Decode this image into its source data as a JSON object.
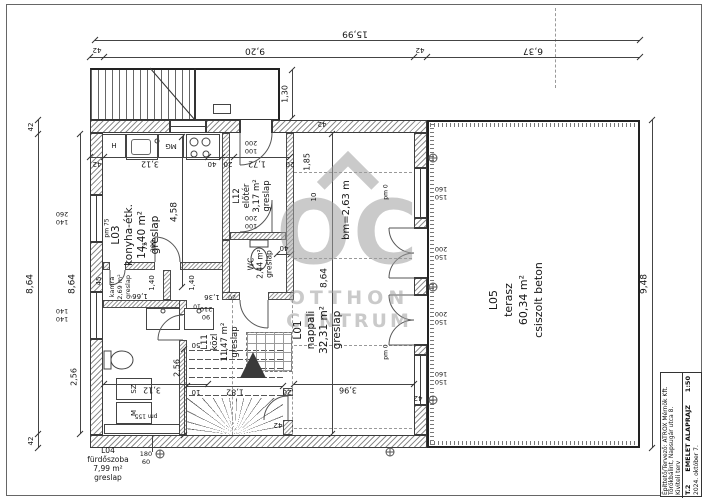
{
  "title_block": {
    "owner_designer": "Építtető/Tervező: ATROX Mérnök Kft.",
    "address": "Törökbálint, Napsugár utca 8.",
    "plan_type": "Kiviteli terv",
    "sheet_number": "T.2",
    "sheet_title": "EMELET ALAPRAJZ",
    "scale": "1:50",
    "date": "2024. október 7."
  },
  "watermark": {
    "monogram": "OC",
    "line1": "OTTHON",
    "line2": "CENTRUM"
  },
  "colors": {
    "line": "#3c3c3c",
    "hatch": "#8d8d8d",
    "watermark": "#c8c8c8"
  },
  "plan": {
    "room_labels": [
      {
        "n": "room-label-l03",
        "lines": [
          "L03",
          "konyha-étk.",
          "14,40 m²",
          "greslap"
        ],
        "x": 136,
        "y": 235,
        "rot": 90,
        "fs": 10.5,
        "lh": 13
      },
      {
        "n": "room-label-l12",
        "lines": [
          "L12",
          "előtér",
          "3,17 m²",
          "greslap"
        ],
        "x": 252,
        "y": 196,
        "rot": 90,
        "fs": 8.5,
        "lh": 10
      },
      {
        "n": "room-label-wc",
        "lines": [
          "WC",
          "2,44 m²",
          "greslap"
        ],
        "x": 260,
        "y": 264,
        "rot": 90,
        "fs": 7.5,
        "lh": 9
      },
      {
        "n": "room-label-kamra",
        "lines": [
          "kamra",
          "2,69 m²",
          "greslap"
        ],
        "x": 120,
        "y": 287,
        "rot": 90,
        "fs": 6.5,
        "lh": 8
      },
      {
        "n": "room-label-l11",
        "lines": [
          "L11",
          "közl",
          "11,47 m²",
          "greslap"
        ],
        "x": 220,
        "y": 342,
        "rot": 90,
        "fs": 8.5,
        "lh": 10
      },
      {
        "n": "room-label-l01",
        "lines": [
          "L01",
          "nappali",
          "32,31 m²",
          "greslap"
        ],
        "x": 318,
        "y": 330,
        "rot": 90,
        "fs": 10.5,
        "lh": 13
      },
      {
        "n": "room-label-l05",
        "lines": [
          "L05",
          "terasz",
          "60,34 m²",
          "csiszolt beton"
        ],
        "x": 516,
        "y": 300,
        "rot": 90,
        "fs": 11,
        "lh": 15
      },
      {
        "n": "room-label-l04",
        "lines": [
          "L04",
          "fürdőszoba",
          "7,99 m²",
          "greslap"
        ],
        "x": 108,
        "y": 464,
        "rot": 0,
        "fs": 7.5,
        "lh": 9
      }
    ],
    "dim_labels": [
      {
        "n": "dim-total-width",
        "t": "15,99",
        "x": 355,
        "y": 33,
        "rot": 180,
        "fs": 9
      },
      {
        "n": "dim",
        "t": "42",
        "x": 97,
        "y": 50,
        "rot": 180,
        "fs": 7
      },
      {
        "n": "dim",
        "t": "9,20",
        "x": 255,
        "y": 50,
        "rot": 180,
        "fs": 9
      },
      {
        "n": "dim",
        "t": "42",
        "x": 420,
        "y": 50,
        "rot": 180,
        "fs": 7
      },
      {
        "n": "dim",
        "t": "6,37",
        "x": 533,
        "y": 50,
        "rot": 180,
        "fs": 9
      },
      {
        "n": "dim",
        "t": "42",
        "x": 31,
        "y": 127,
        "rot": 90,
        "fs": 7
      },
      {
        "n": "dim",
        "t": "8,64",
        "x": 31,
        "y": 284,
        "rot": 90,
        "fs": 9
      },
      {
        "n": "dim",
        "t": "42",
        "x": 31,
        "y": 441,
        "rot": 90,
        "fs": 7
      },
      {
        "n": "dim",
        "t": "8,64",
        "x": 73,
        "y": 284,
        "rot": 90,
        "fs": 9
      },
      {
        "n": "dim",
        "t": "2,56",
        "x": 74,
        "y": 377,
        "rot": 90,
        "fs": 8
      },
      {
        "n": "dim",
        "t": "9,48",
        "x": 645,
        "y": 284,
        "rot": 90,
        "fs": 9
      },
      {
        "n": "dim",
        "t": "1,30",
        "x": 285,
        "y": 94,
        "rot": 90,
        "fs": 8
      },
      {
        "n": "dim",
        "t": "42",
        "x": 97,
        "y": 164,
        "rot": 180,
        "fs": 7
      },
      {
        "n": "dim",
        "t": "3,12",
        "x": 150,
        "y": 164,
        "rot": 180,
        "fs": 8
      },
      {
        "n": "dim",
        "t": "40",
        "x": 212,
        "y": 164,
        "rot": 180,
        "fs": 7
      },
      {
        "n": "dim",
        "t": "20",
        "x": 228,
        "y": 164,
        "rot": 180,
        "fs": 7
      },
      {
        "n": "dim",
        "t": "1,72",
        "x": 257,
        "y": 164,
        "rot": 180,
        "fs": 8
      },
      {
        "n": "dim",
        "t": "20",
        "x": 290,
        "y": 164,
        "rot": 180,
        "fs": 7
      },
      {
        "n": "dim",
        "t": "42",
        "x": 322,
        "y": 124,
        "rot": 180,
        "fs": 7
      },
      {
        "n": "dim",
        "t": "1,85",
        "x": 307,
        "y": 162,
        "rot": 90,
        "fs": 8
      },
      {
        "n": "dim",
        "t": "10",
        "x": 314,
        "y": 197,
        "rot": 90,
        "fs": 7
      },
      {
        "n": "dim",
        "t": "4,58",
        "x": 175,
        "y": 212,
        "rot": 90,
        "fs": 9
      },
      {
        "n": "dim",
        "t": "pm 75",
        "x": 107,
        "y": 228,
        "rot": 90,
        "fs": 6
      },
      {
        "n": "dim",
        "t": "40",
        "x": 284,
        "y": 248,
        "rot": 180,
        "fs": 7
      },
      {
        "n": "dim",
        "t": "8,64",
        "x": 325,
        "y": 278,
        "rot": 90,
        "fs": 9
      },
      {
        "n": "dim-room-height",
        "t": "bm=2,63 m",
        "x": 347,
        "y": 210,
        "rot": 90,
        "fs": 10
      },
      {
        "n": "dim",
        "t": "pm 0",
        "x": 386,
        "y": 192,
        "rot": 90,
        "fs": 6
      },
      {
        "n": "dim",
        "t": "pm 0",
        "x": 386,
        "y": 352,
        "rot": 90,
        "fs": 6
      },
      {
        "n": "window-size",
        "lines": [
          "140",
          "260"
        ],
        "x": 62,
        "y": 218,
        "rot": 180,
        "fs": 6.5
      },
      {
        "n": "window-size",
        "lines": [
          "140",
          "140"
        ],
        "x": 62,
        "y": 315,
        "rot": 180,
        "fs": 6.5
      },
      {
        "n": "window-size",
        "lines": [
          "150",
          "160"
        ],
        "x": 441,
        "y": 193,
        "rot": 180,
        "fs": 6.5
      },
      {
        "n": "door-size",
        "lines": [
          "150",
          "200"
        ],
        "x": 441,
        "y": 253,
        "rot": 180,
        "fs": 6.5
      },
      {
        "n": "door-size",
        "lines": [
          "150",
          "200"
        ],
        "x": 441,
        "y": 318,
        "rot": 180,
        "fs": 6.5
      },
      {
        "n": "window-size",
        "lines": [
          "150",
          "160"
        ],
        "x": 441,
        "y": 378,
        "rot": 180,
        "fs": 6.5
      },
      {
        "n": "door-size",
        "lines": [
          "100",
          "200"
        ],
        "x": 251,
        "y": 147,
        "rot": 180,
        "fs": 6.5
      },
      {
        "n": "door-size",
        "lines": [
          "100",
          "200"
        ],
        "x": 251,
        "y": 222,
        "rot": 180,
        "fs": 6.5
      },
      {
        "n": "door-size",
        "lines": [
          "75",
          "200"
        ],
        "x": 149,
        "y": 246,
        "rot": 90,
        "fs": 6.5
      },
      {
        "n": "door-size",
        "lines": [
          "90",
          "210"
        ],
        "x": 206,
        "y": 313,
        "rot": 180,
        "fs": 6.5
      },
      {
        "n": "dim",
        "t": "1,66",
        "x": 140,
        "y": 296,
        "rot": 180,
        "fs": 7
      },
      {
        "n": "dim",
        "t": "1,40",
        "x": 152,
        "y": 283,
        "rot": 90,
        "fs": 7
      },
      {
        "n": "dim",
        "t": "1,40",
        "x": 192,
        "y": 283,
        "rot": 90,
        "fs": 7
      },
      {
        "n": "dim",
        "t": "1,36",
        "x": 212,
        "y": 297,
        "rot": 180,
        "fs": 7
      },
      {
        "n": "dim",
        "t": "10",
        "x": 197,
        "y": 306,
        "rot": 180,
        "fs": 6
      },
      {
        "n": "dim",
        "t": "20",
        "x": 232,
        "y": 297,
        "rot": 180,
        "fs": 6
      },
      {
        "n": "dim",
        "t": "45",
        "x": 99,
        "y": 281,
        "rot": 90,
        "fs": 7
      },
      {
        "n": "dim",
        "t": "50",
        "x": 196,
        "y": 345,
        "rot": 180,
        "fs": 7
      },
      {
        "n": "dim",
        "t": "3,12",
        "x": 152,
        "y": 390,
        "rot": 180,
        "fs": 8
      },
      {
        "n": "dim",
        "t": "pm 155",
        "x": 146,
        "y": 416,
        "rot": 180,
        "fs": 6
      },
      {
        "n": "dim",
        "t": "10",
        "x": 196,
        "y": 392,
        "rot": 180,
        "fs": 7
      },
      {
        "n": "dim",
        "t": "1,82",
        "x": 235,
        "y": 392,
        "rot": 180,
        "fs": 8
      },
      {
        "n": "dim",
        "t": "20",
        "x": 287,
        "y": 392,
        "rot": 180,
        "fs": 7
      },
      {
        "n": "dim",
        "t": "42",
        "x": 278,
        "y": 425,
        "rot": 180,
        "fs": 7
      },
      {
        "n": "dim",
        "t": "3,96",
        "x": 348,
        "y": 390,
        "rot": 180,
        "fs": 8
      },
      {
        "n": "dim",
        "t": "42",
        "x": 418,
        "y": 398,
        "rot": 180,
        "fs": 7
      },
      {
        "n": "dim",
        "t": "2,56",
        "x": 177,
        "y": 368,
        "rot": 90,
        "fs": 8
      },
      {
        "n": "fixture-label-fridge",
        "t": "H",
        "x": 114,
        "y": 146,
        "rot": 0,
        "fs": 7
      },
      {
        "n": "fixture-label-dishwasher",
        "t": "MG",
        "x": 171,
        "y": 146,
        "rot": 180,
        "fs": 7
      },
      {
        "n": "fixture-label-dryer",
        "t": "SZ",
        "x": 134,
        "y": 389,
        "rot": 90,
        "fs": 7
      },
      {
        "n": "fixture-label-washer",
        "t": "M",
        "x": 134,
        "y": 413,
        "rot": 90,
        "fs": 7
      },
      {
        "n": "fixture-size-tub",
        "lines": [
          "180",
          "60"
        ],
        "x": 146,
        "y": 458,
        "rot": 0,
        "fs": 6.5
      }
    ]
  }
}
